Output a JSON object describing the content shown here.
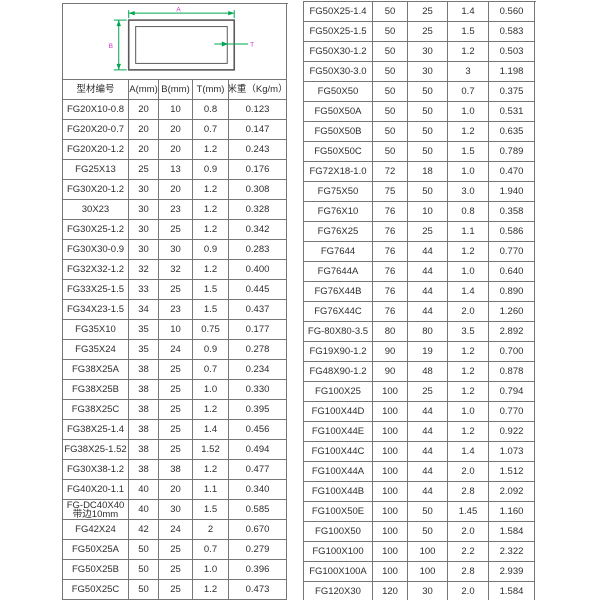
{
  "colors": {
    "table_border": "#767676",
    "text": "#2e2e2e",
    "dimension_line": "#00a651",
    "dimension_label": "#cc2fcc",
    "profile_outline": "#5a5a5a"
  },
  "diagram": {
    "label_a": "A",
    "label_b": "B",
    "label_t": "T"
  },
  "table": {
    "headers": [
      "型材编号",
      "A(mm)",
      "B(mm)",
      "T(mm)",
      "米重（Kg/m）"
    ],
    "left_rows": [
      [
        "FG20X10-0.8",
        "20",
        "10",
        "0.8",
        "0.123"
      ],
      [
        "FG20X20-0.7",
        "20",
        "20",
        "0.7",
        "0.147"
      ],
      [
        "FG20X20-1.2",
        "20",
        "20",
        "1.2",
        "0.243"
      ],
      [
        "FG25X13",
        "25",
        "13",
        "0.9",
        "0.176"
      ],
      [
        "FG30X20-1.2",
        "30",
        "20",
        "1.2",
        "0.308"
      ],
      [
        "30X23",
        "30",
        "23",
        "1.2",
        "0.328"
      ],
      [
        "FG30X25-1.2",
        "30",
        "25",
        "1.2",
        "0.342"
      ],
      [
        "FG30X30-0.9",
        "30",
        "30",
        "0.9",
        "0.283"
      ],
      [
        "FG32X32-1.2",
        "32",
        "32",
        "1.2",
        "0.400"
      ],
      [
        "FG33X25-1.5",
        "33",
        "25",
        "1.5",
        "0.445"
      ],
      [
        "FG34X23-1.5",
        "34",
        "23",
        "1.5",
        "0.437"
      ],
      [
        "FG35X10",
        "35",
        "10",
        "0.75",
        "0.177"
      ],
      [
        "FG35X24",
        "35",
        "24",
        "0.9",
        "0.278"
      ],
      [
        "FG38X25A",
        "38",
        "25",
        "0.7",
        "0.234"
      ],
      [
        "FG38X25B",
        "38",
        "25",
        "1.0",
        "0.330"
      ],
      [
        "FG38X25C",
        "38",
        "25",
        "1.2",
        "0.395"
      ],
      [
        "FG38X25-1.4",
        "38",
        "25",
        "1.4",
        "0.456"
      ],
      [
        "FG38X25-1.52",
        "38",
        "25",
        "1.52",
        "0.494"
      ],
      [
        "FG30X38-1.2",
        "38",
        "38",
        "1.2",
        "0.477"
      ],
      [
        "FG40X20-1.1",
        "40",
        "20",
        "1.1",
        "0.340"
      ],
      [
        "FG-DC40X40\n带边10mm",
        "40",
        "30",
        "1.5",
        "0.585"
      ],
      [
        "FG42X24",
        "42",
        "24",
        "2",
        "0.670"
      ],
      [
        "FG50X25A",
        "50",
        "25",
        "0.7",
        "0.279"
      ],
      [
        "FG50X25B",
        "50",
        "25",
        "1.0",
        "0.396"
      ],
      [
        "FG50X25C",
        "50",
        "25",
        "1.2",
        "0.473"
      ]
    ],
    "right_rows": [
      [
        "FG50X25-1.4",
        "50",
        "25",
        "1.4",
        "0.560"
      ],
      [
        "FG50X25-1.5",
        "50",
        "25",
        "1.5",
        "0.583"
      ],
      [
        "FG50X30-1.2",
        "50",
        "30",
        "1.2",
        "0.503"
      ],
      [
        "FG50X30-3.0",
        "50",
        "30",
        "3",
        "1.198"
      ],
      [
        "FG50X50",
        "50",
        "50",
        "0.7",
        "0.375"
      ],
      [
        "FG50X50A",
        "50",
        "50",
        "1.0",
        "0.531"
      ],
      [
        "FG50X50B",
        "50",
        "50",
        "1.2",
        "0.635"
      ],
      [
        "FG50X50C",
        "50",
        "50",
        "1.5",
        "0.789"
      ],
      [
        "FG72X18-1.0",
        "72",
        "18",
        "1.0",
        "0.470"
      ],
      [
        "FG75X50",
        "75",
        "50",
        "3.0",
        "1.940"
      ],
      [
        "FG76X10",
        "76",
        "10",
        "0.8",
        "0.358"
      ],
      [
        "FG76X25",
        "76",
        "25",
        "1.1",
        "0.586"
      ],
      [
        "FG7644",
        "76",
        "44",
        "1.2",
        "0.770"
      ],
      [
        "FG7644A",
        "76",
        "44",
        "1.0",
        "0.640"
      ],
      [
        "FG76X44B",
        "76",
        "44",
        "1.4",
        "0.890"
      ],
      [
        "FG76X44C",
        "76",
        "44",
        "2.0",
        "1.260"
      ],
      [
        "FG-80X80-3.5",
        "80",
        "80",
        "3.5",
        "2.892"
      ],
      [
        "FG19X90-1.2",
        "90",
        "19",
        "1.2",
        "0.700"
      ],
      [
        "FG48X90-1.2",
        "90",
        "48",
        "1.2",
        "0.878"
      ],
      [
        "FG100X25",
        "100",
        "25",
        "1.2",
        "0.794"
      ],
      [
        "FG100X44D",
        "100",
        "44",
        "1.0",
        "0.770"
      ],
      [
        "FG100X44E",
        "100",
        "44",
        "1.2",
        "0.922"
      ],
      [
        "FG100X44C",
        "100",
        "44",
        "1.4",
        "1.073"
      ],
      [
        "FG100X44A",
        "100",
        "44",
        "2.0",
        "1.512"
      ],
      [
        "FG100X44B",
        "100",
        "44",
        "2.8",
        "2.092"
      ],
      [
        "FG100X50E",
        "100",
        "50",
        "1.45",
        "1.160"
      ],
      [
        "FG100X50",
        "100",
        "50",
        "2.0",
        "1.584"
      ],
      [
        "FG100X100",
        "100",
        "100",
        "2.2",
        "2.322"
      ],
      [
        "FG100X100A",
        "100",
        "100",
        "2.8",
        "2.939"
      ],
      [
        "FG120X30",
        "120",
        "30",
        "2.0",
        "1.584"
      ]
    ]
  }
}
